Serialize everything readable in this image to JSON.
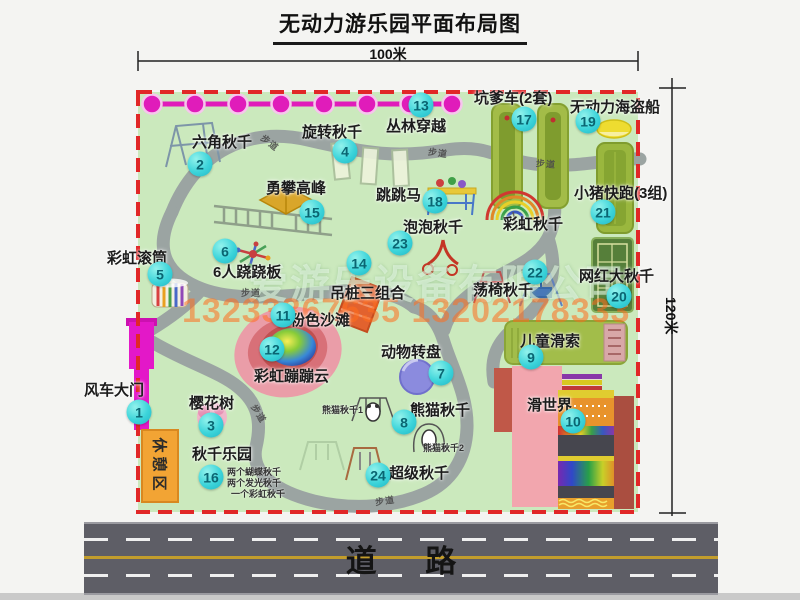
{
  "title": "无动力游乐园平面布局图",
  "dim_width": "100米",
  "dim_height": "120米",
  "road_label": "道 路",
  "trail": "步道",
  "rest_area": "休憩区",
  "rainbow_swing": "彩虹秋千",
  "watermark": {
    "company": "爱游乐设备有限公司",
    "phones": "13233867635 13202178333"
  },
  "swing_park_notes": [
    "两个蝴蝶秋千",
    "两个发光秋千",
    "一个彩虹秋千"
  ],
  "panda_sub_labels": [
    "熊猫秋千1",
    "熊猫秋千2"
  ],
  "attractions": [
    {
      "num": "1",
      "name": "风车大门"
    },
    {
      "num": "2",
      "name": "六角秋千"
    },
    {
      "num": "3",
      "name": "樱花树"
    },
    {
      "num": "4",
      "name": "旋转秋千"
    },
    {
      "num": "5",
      "name": "彩虹滚筒"
    },
    {
      "num": "6",
      "name": "6人跷跷板"
    },
    {
      "num": "7",
      "name": "动物转盘"
    },
    {
      "num": "8",
      "name": "熊猫秋千"
    },
    {
      "num": "9",
      "name": "儿童滑索"
    },
    {
      "num": "10",
      "name": "滑世界"
    },
    {
      "num": "11",
      "name": "粉色沙滩"
    },
    {
      "num": "12",
      "name": "彩虹蹦蹦云"
    },
    {
      "num": "13",
      "name": "丛林穿越"
    },
    {
      "num": "14",
      "name": "吊桩三组合"
    },
    {
      "num": "15",
      "name": "勇攀高峰"
    },
    {
      "num": "16",
      "name": "秋千乐园"
    },
    {
      "num": "17",
      "name": "坑爹车(2套)"
    },
    {
      "num": "18",
      "name": "跳跳马"
    },
    {
      "num": "19",
      "name": "无动力海盗船"
    },
    {
      "num": "20",
      "name": "网红大秋千"
    },
    {
      "num": "21",
      "name": "小猪快跑(3组)"
    },
    {
      "num": "22",
      "name": "荡椅秋千"
    },
    {
      "num": "23",
      "name": "泡泡秋千"
    },
    {
      "num": "24",
      "name": "超级秋千"
    }
  ],
  "colors": {
    "map_green": "#cbe9bd",
    "border_red": "#e12727",
    "badge_cyan": "#3cd4da",
    "gate_magenta": "#e318c8",
    "rest_orange": "#f2a434",
    "road_gray": "#5e5e66"
  }
}
